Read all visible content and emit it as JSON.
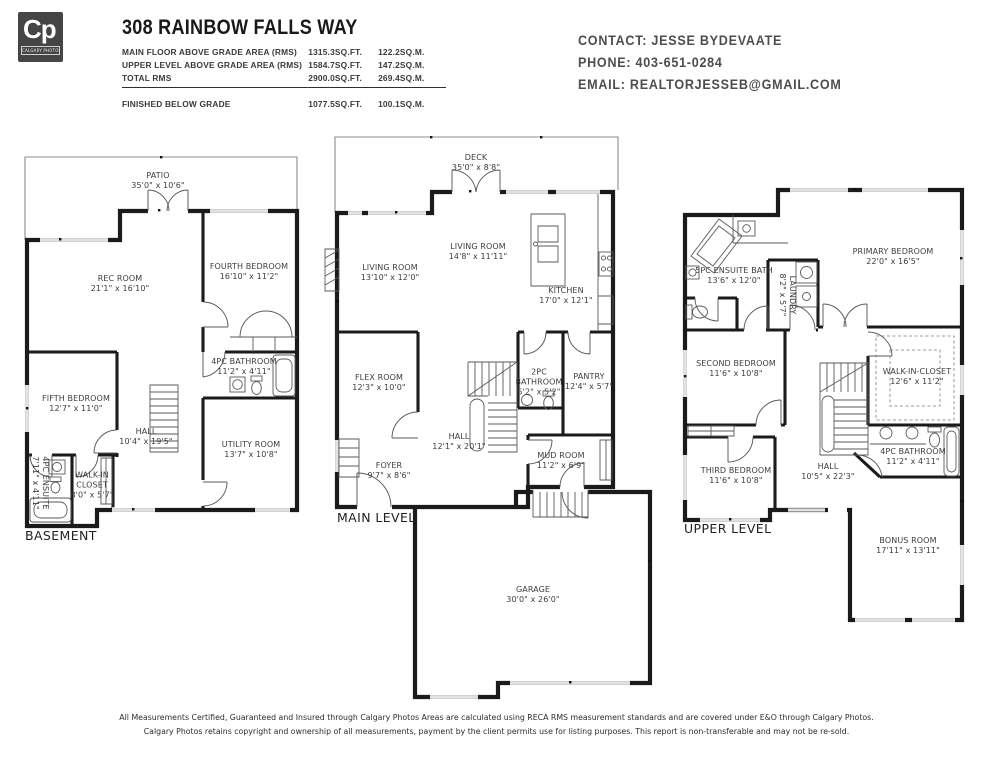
{
  "header": {
    "logo": {
      "text": "Cp",
      "subtext": "CALGARY PHOTOS"
    },
    "title": "308 RAINBOW FALLS WAY",
    "area_rows": [
      {
        "label": "MAIN FLOOR ABOVE GRADE AREA (RMS)",
        "sqft": "1315.3SQ.FT.",
        "sqm": "122.2SQ.M."
      },
      {
        "label": "UPPER LEVEL ABOVE GRADE AREA (RMS)",
        "sqft": "1584.7SQ.FT.",
        "sqm": "147.2SQ.M."
      },
      {
        "label": "TOTAL RMS",
        "sqft": "2900.0SQ.FT.",
        "sqm": "269.4SQ.M."
      },
      {
        "label": "FINISHED BELOW GRADE",
        "sqft": "1077.5SQ.FT.",
        "sqm": "100.1SQ.M."
      }
    ],
    "contact": {
      "contact": "CONTACT: JESSE BYDEVAATE",
      "phone": "PHONE: 403-651-0284",
      "email": "EMAIL: REALTORJESSEB@GMAIL.COM"
    }
  },
  "plans": {
    "basement": {
      "label": "BASEMENT",
      "rooms": [
        {
          "name": "PATIO",
          "dims": "35'0\" x 10'6\""
        },
        {
          "name": "REC ROOM",
          "dims": "21'1\" x 16'10\""
        },
        {
          "name": "FOURTH BEDROOM",
          "dims": "16'10\" x 11'2\""
        },
        {
          "name": "4PC BATHROOM",
          "dims": "11'2\" x 4'11\""
        },
        {
          "name": "FIFTH BEDROOM",
          "dims": "12'7\" x 11'0\""
        },
        {
          "name": "HALL",
          "dims": "10'4\" x 19'5\""
        },
        {
          "name": "UTILITY ROOM",
          "dims": "13'7\" x 10'8\""
        },
        {
          "name": "WALK-IN CLOSET",
          "dims": "8'0\" x 5'7\""
        },
        {
          "name": "4PC ENSUITE",
          "dims": "7'11\" x 4'11\""
        }
      ]
    },
    "main": {
      "label": "MAIN LEVEL",
      "rooms": [
        {
          "name": "DECK",
          "dims": "35'0\" x 8'8\""
        },
        {
          "name": "LIVING ROOM",
          "dims": "14'8\" x 11'11\""
        },
        {
          "name": "LIVING ROOM",
          "dims": "13'10\" x 12'0\""
        },
        {
          "name": "KITCHEN",
          "dims": "17'0\" x 12'1\""
        },
        {
          "name": "FLEX ROOM",
          "dims": "12'3\" x 10'0\""
        },
        {
          "name": "2PC BATHROOM",
          "dims": "5'2\" x 5'2\""
        },
        {
          "name": "PANTRY",
          "dims": "12'4\" x 5'7\""
        },
        {
          "name": "HALL",
          "dims": "12'1\" x 20'1\""
        },
        {
          "name": "FOYER",
          "dims": "9'7\" x 8'6\""
        },
        {
          "name": "MUD ROOM",
          "dims": "11'2\" x 6'9\""
        },
        {
          "name": "GARAGE",
          "dims": "30'0\" x 26'0\""
        }
      ]
    },
    "upper": {
      "label": "UPPER LEVEL",
      "rooms": [
        {
          "name": "5PC ENSUITE BATH",
          "dims": "13'6\" x 12'0\""
        },
        {
          "name": "LAUNDRY",
          "dims": "8'2\" x 5'7\""
        },
        {
          "name": "PRIMARY BEDROOM",
          "dims": "22'0\" x 16'5\""
        },
        {
          "name": "SECOND BEDROOM",
          "dims": "11'6\" x 10'8\""
        },
        {
          "name": "WALK-IN-CLOSET",
          "dims": "12'6\" x 11'2\""
        },
        {
          "name": "THIRD BEDROOM",
          "dims": "11'6\" x 10'8\""
        },
        {
          "name": "HALL",
          "dims": "10'5\" x 22'3\""
        },
        {
          "name": "4PC BATHROOM",
          "dims": "11'2\" x 4'11\""
        },
        {
          "name": "BONUS ROOM",
          "dims": "17'11\" x 13'11\""
        }
      ]
    }
  },
  "footer": {
    "line1": "All Measurements Certified, Guaranteed and Insured through Calgary Photos Areas are calculated using RECA RMS measurement standards and are covered under E&O through Calgary Photos.",
    "line2": "Calgary Photos retains copyright and ownership of all measurements, payment by the client permits use for listing purposes. This report is non-transferable and may not be re-sold."
  }
}
